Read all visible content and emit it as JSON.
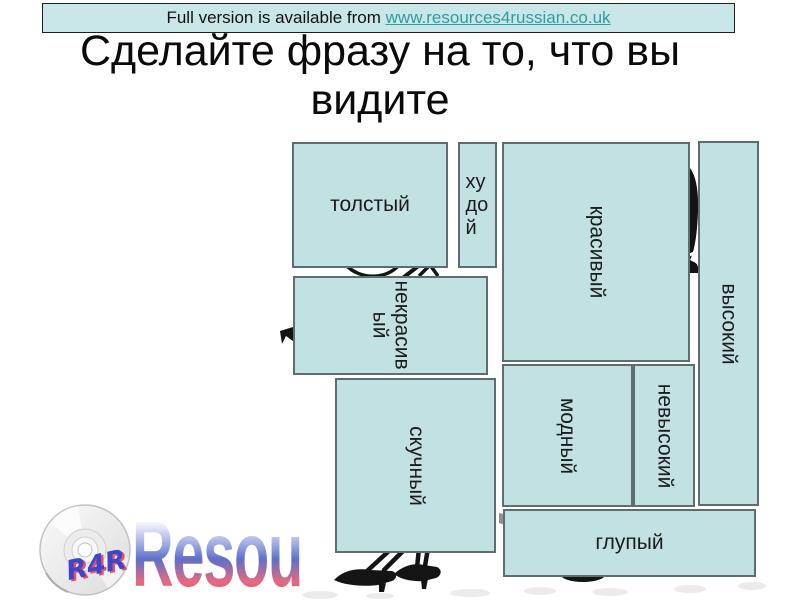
{
  "banner": {
    "prefix": "Full version is available from ",
    "link_text": "www.resources4russian.co.uk"
  },
  "title": {
    "line1": "Сделайте фразу на то, что вы",
    "line2": "видите"
  },
  "word_boxes": [
    {
      "label": "толстый"
    },
    {
      "label": "худой"
    },
    {
      "label": "красивый"
    },
    {
      "label": "высокий"
    },
    {
      "label": "некрасивый"
    },
    {
      "label": "скучный"
    },
    {
      "label": "модный"
    },
    {
      "label": "невысокий"
    },
    {
      "label": "глупый"
    }
  ],
  "logo": {
    "cd_text": "R4R",
    "brand_text": "Resou"
  },
  "colors": {
    "box_fill": "#c2e1e3",
    "box_border": "#5d6d70",
    "banner_fill": "#c9e7e8",
    "link": "#2e9d9d",
    "brand_blue": "#5f70ca",
    "brand_red": "#dd4053",
    "silhouette": "#141414"
  }
}
